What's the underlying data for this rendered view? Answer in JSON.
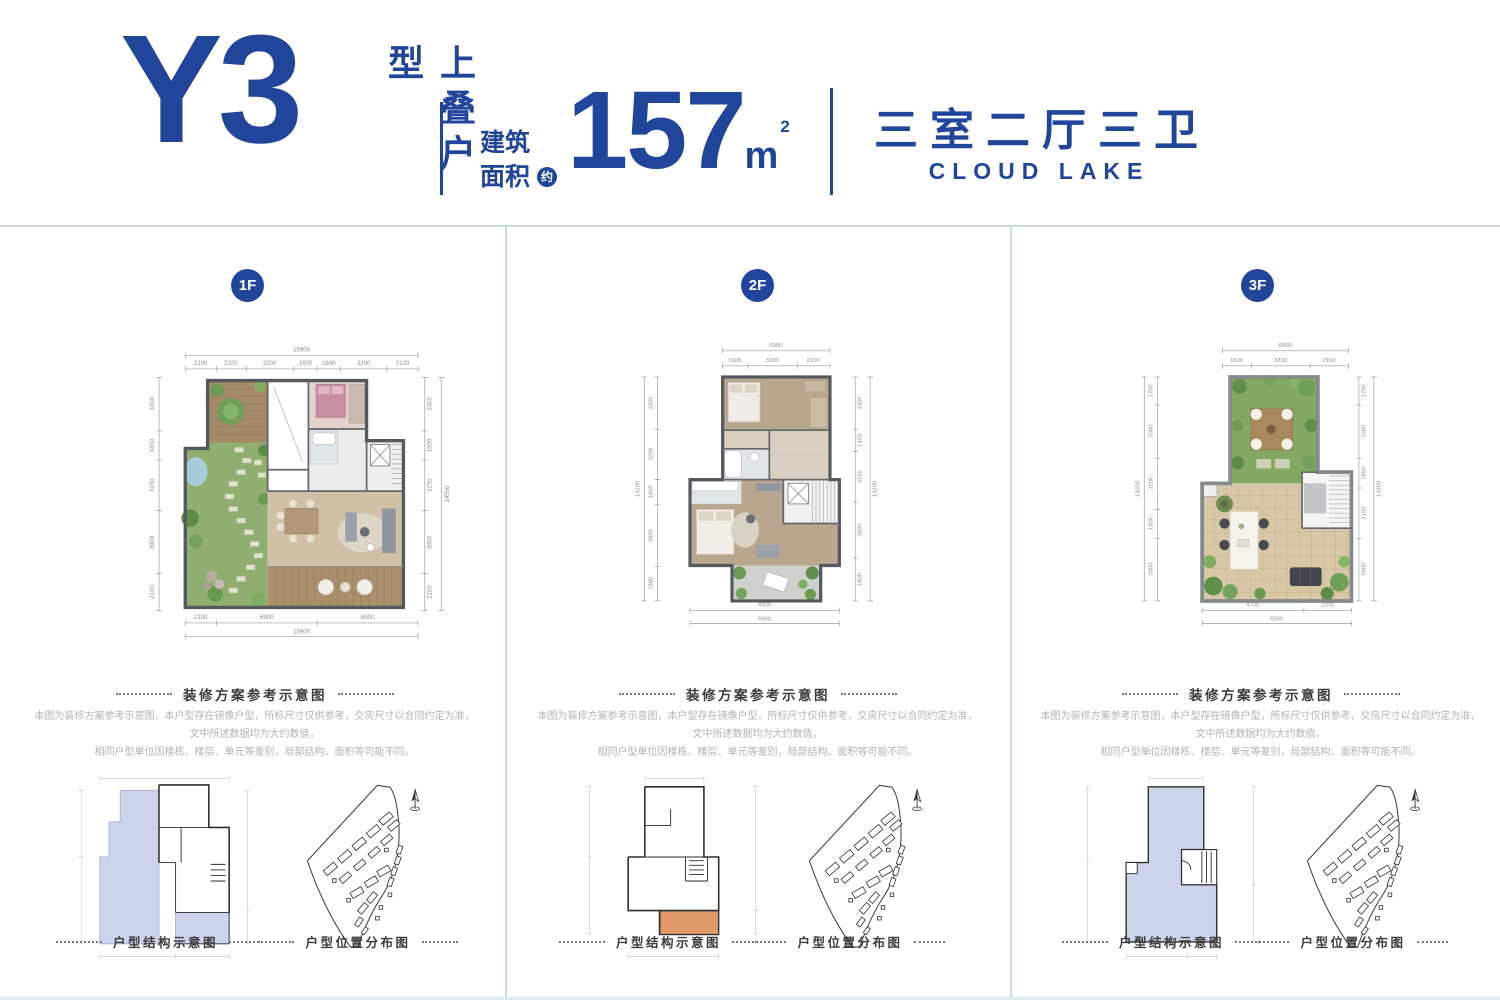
{
  "brand_colors": {
    "primary_blue": "#20459a",
    "rule_blue": "#c6dce2",
    "structure_lavender": "#ccd4ec",
    "structure_orange": "#e09a67"
  },
  "header": {
    "unit_code": "Y3",
    "unit_tag": "上叠户型",
    "area_label_1": "建筑",
    "area_label_2": "面积",
    "area_approx": "约",
    "area_value": "157",
    "area_unit": "m",
    "area_unit_sup": "2",
    "rooms": "三室二厅三卫",
    "brand": "CLOUD LAKE"
  },
  "captions": {
    "plan": "装修方案参考示意图",
    "structure": "户型结构示意图",
    "location": "户型位置分布图"
  },
  "disclaimer": {
    "line1": "本图为装修方案参考示意图，本户型存在镜像户型，所标尺寸仅供参考，交房尺寸以合同约定为准，文中所述数据均为大约数值，",
    "line2": "相同户型单位因楼栋、楼层、单元等差别，局部结构、面积等可能不同。"
  },
  "floors": [
    {
      "badge": "1F",
      "dims": {
        "top_total": "15900",
        "top": [
          "2100",
          "2100",
          "3200",
          "1600",
          "1600",
          "3200",
          "2100"
        ],
        "left": [
          "3300",
          "1850",
          "3150",
          "3900",
          "2100"
        ],
        "right": [
          "3300",
          "1800",
          "3150",
          "3900",
          "2100"
        ],
        "right_total": "14500",
        "bottom": [
          "2100",
          "6900",
          "6900"
        ],
        "bottom_total": "15900"
      }
    },
    {
      "badge": "2F",
      "dims": {
        "top_total": "6900",
        "top": [
          "1600",
          "3200",
          "2100"
        ],
        "left": [
          "3300",
          "3200",
          "1600",
          "3900",
          "1800"
        ],
        "left_total": "14200",
        "right": [
          "3300",
          "1450",
          "3150",
          "3600",
          "1800"
        ],
        "right_total": "14200",
        "bottom": [
          "6900"
        ],
        "bottom_total": "6900"
      }
    },
    {
      "badge": "3F",
      "dims": {
        "top_total": "6900",
        "top": [
          "1600",
          "3200",
          "2100"
        ],
        "left": [
          "1750",
          "3300",
          "3200",
          "1800",
          "3900"
        ],
        "left_total": "13950",
        "right": [
          "1750",
          "3300",
          "1850",
          "3150",
          "3900"
        ],
        "right_total": "13950",
        "bottom": [
          "4700",
          "2200"
        ],
        "bottom_total": "6900"
      }
    }
  ]
}
